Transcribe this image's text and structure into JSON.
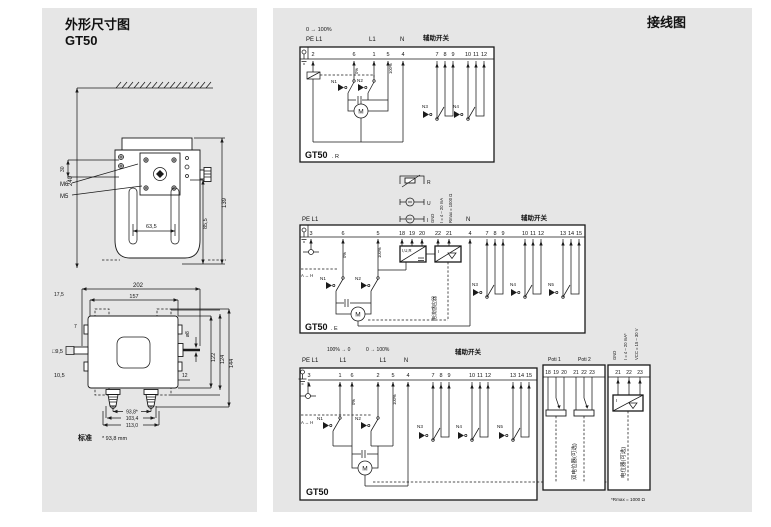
{
  "colors": {
    "panel_bg": "#e6e6e6",
    "line": "#1a1a1a",
    "box_bg": "#ffffff"
  },
  "left": {
    "title": "外形尺寸图",
    "model": "GT50",
    "front": {
      "d240": "240",
      "d30": "30",
      "m6": "M6",
      "m5": "M5",
      "d139": "139",
      "d85_5": "85,5",
      "d63_5": "63,5"
    },
    "top": {
      "d202": "202",
      "d157": "157",
      "d17_5": "17,5",
      "d7": "7",
      "sq9_5": "□9,5",
      "d10_5": "10,5",
      "dia8": "ø8",
      "d122": "122",
      "d124": "124",
      "d144": "144",
      "d12": "12",
      "d93_8": "93,8*",
      "d103_4": "103,4",
      "d113_0": "113,0",
      "std_label": "标准",
      "std_note": "* 93,8 mm"
    }
  },
  "right": {
    "title": "接线图",
    "r": {
      "range": "0 → 100%",
      "pe": "PE L1",
      "l1": "L1",
      "n": "N",
      "aux": "辅助开关",
      "terms": [
        "2",
        "6",
        "1",
        "5",
        "4"
      ],
      "aux1": [
        "7",
        "8",
        "9"
      ],
      "aux2": [
        "10",
        "11",
        "12"
      ],
      "pct0": "0%",
      "pct100": "100%",
      "sw": [
        "N1",
        "N2",
        "N3",
        "N4"
      ],
      "motor": "M",
      "model": "GT50",
      "suffix": ". R"
    },
    "src": {
      "r": "R",
      "u": "U",
      "i": "I",
      "gnd": "GND",
      "ma": "I = 4 – 20 mA",
      "rmax": "Rmax = 1000 Ω"
    },
    "e": {
      "pe": "PE L1",
      "n_label": "N",
      "aux": "辅助开关",
      "terms": [
        "3",
        "6",
        "5"
      ],
      "inp": [
        "18",
        "19",
        "20"
      ],
      "outp": [
        "22",
        "21"
      ],
      "n_term": "4",
      "aux1": [
        "7",
        "8",
        "9"
      ],
      "aux2": [
        "10",
        "11",
        "12"
      ],
      "aux3": [
        "13",
        "14",
        "15"
      ],
      "pct0": "0%",
      "pct100": "100%",
      "ah": "A ↔ H",
      "conv1": "I,U,R",
      "conv2": "I",
      "sensor": "电流感应器",
      "sw": [
        "N1",
        "N2",
        "N3",
        "N4",
        "N5"
      ],
      "motor": "M",
      "model": "GT50",
      "suffix": ". E"
    },
    "s": {
      "range1": "100% → 0",
      "range2": "0 → 100%",
      "pe": "PE L1",
      "l1a": "L1",
      "l1b": "L1",
      "n_label": "N",
      "aux": "辅助开关",
      "terms": [
        "3",
        "1",
        "6",
        "2",
        "5",
        "4"
      ],
      "aux1": [
        "7",
        "8",
        "9"
      ],
      "aux2": [
        "10",
        "11",
        "12"
      ],
      "aux3": [
        "13",
        "14",
        "15"
      ],
      "pct0": "0%",
      "pct100": "100%",
      "ah": "A ↔ H",
      "sw": [
        "N1",
        "N2",
        "N3",
        "N4",
        "N5"
      ],
      "motor": "M",
      "model": "GT50"
    },
    "poti": {
      "h1": "Poti 1",
      "h2": "Poti 2",
      "g1": [
        "18",
        "19",
        "20"
      ],
      "g2": [
        "21",
        "22",
        "23"
      ],
      "label": "双电位器(可选)"
    },
    "cur": {
      "gnd": "GND",
      "ma": "I = 4 – 20 mA*",
      "vcc": "VCC = 15 – 30 V",
      "terms": [
        "21",
        "22",
        "23"
      ],
      "conv": "I",
      "label": "电位器(可选)",
      "footnote": "*Rmax = 1000 Ω"
    }
  }
}
